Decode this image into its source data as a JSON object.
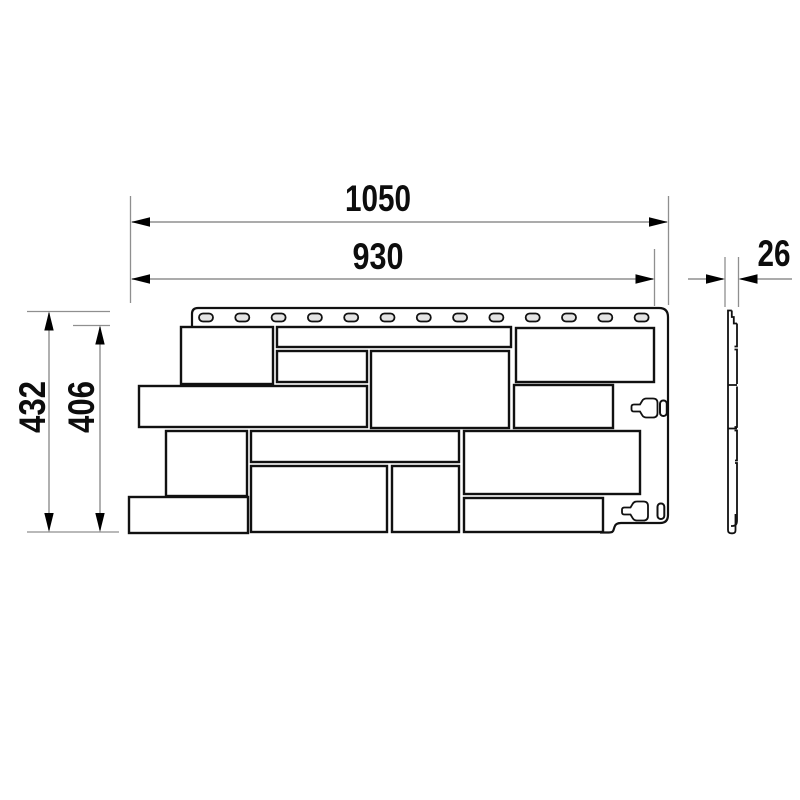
{
  "drawing": {
    "type": "technical dimension drawing",
    "subject": "facade siding panel — front view and side (thickness) profile",
    "dimensions": {
      "overall_width": "1050",
      "panel_width": "930",
      "overall_height": "432",
      "panel_height": "406",
      "thickness": "26"
    },
    "features": {
      "nail_slot_count": 13,
      "stone_block_count": 14,
      "keyhole_latch_count": 2
    },
    "colors": {
      "outline": "#111111",
      "dimension_line": "#8f8f8f",
      "arrow": "#000000",
      "slot_fill": "#e4e4e4",
      "background": "#ffffff"
    }
  }
}
